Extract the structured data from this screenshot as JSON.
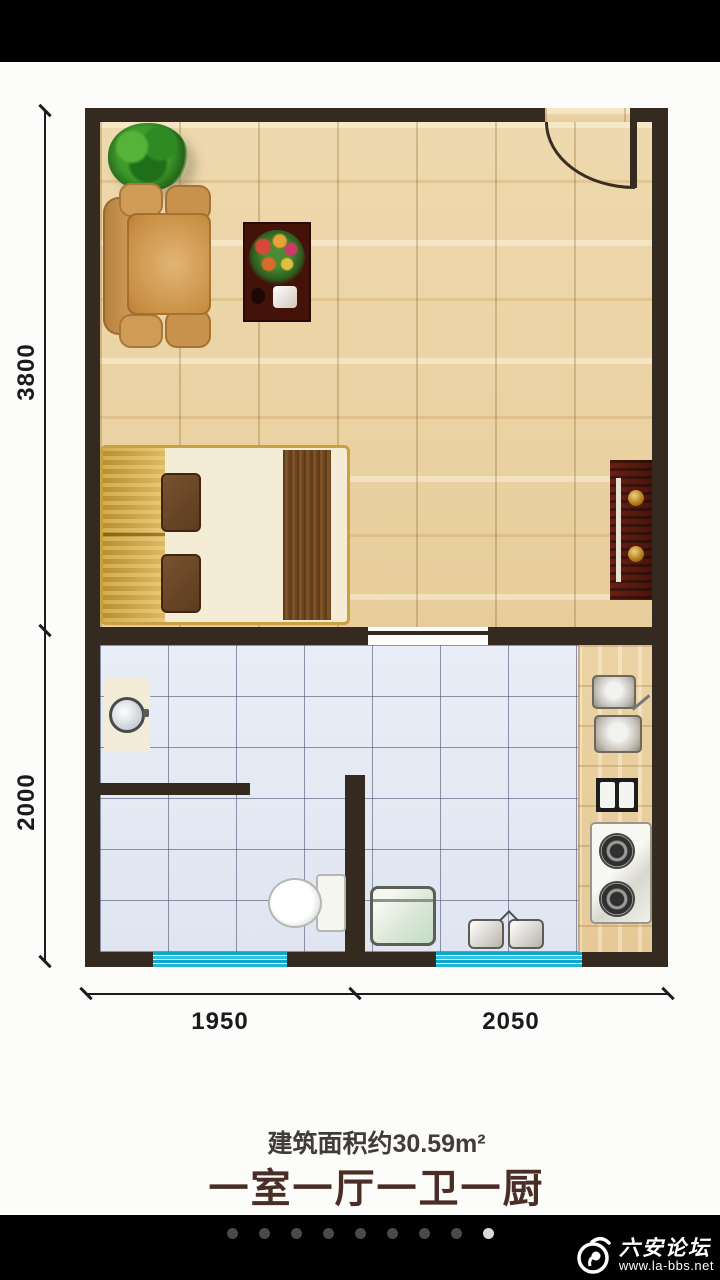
{
  "floorplan": {
    "dimensions": {
      "height_upper": "3800",
      "height_lower": "2000",
      "width_left": "1950",
      "width_right": "2050"
    },
    "area_label": "建筑面积约30.59m²",
    "layout_title": "一室一厅一卫一厨",
    "colors": {
      "wall": "#342a20",
      "wood_floor": "#ead3a6",
      "tile_floor": "#e4e9f4",
      "window": "#1db4d8",
      "title_text": "#4a2d25"
    }
  },
  "pagination": {
    "count": 9,
    "active_index": 8
  },
  "watermark": {
    "site_name": "六安论坛",
    "site_url": "www.la-bbs.net"
  }
}
